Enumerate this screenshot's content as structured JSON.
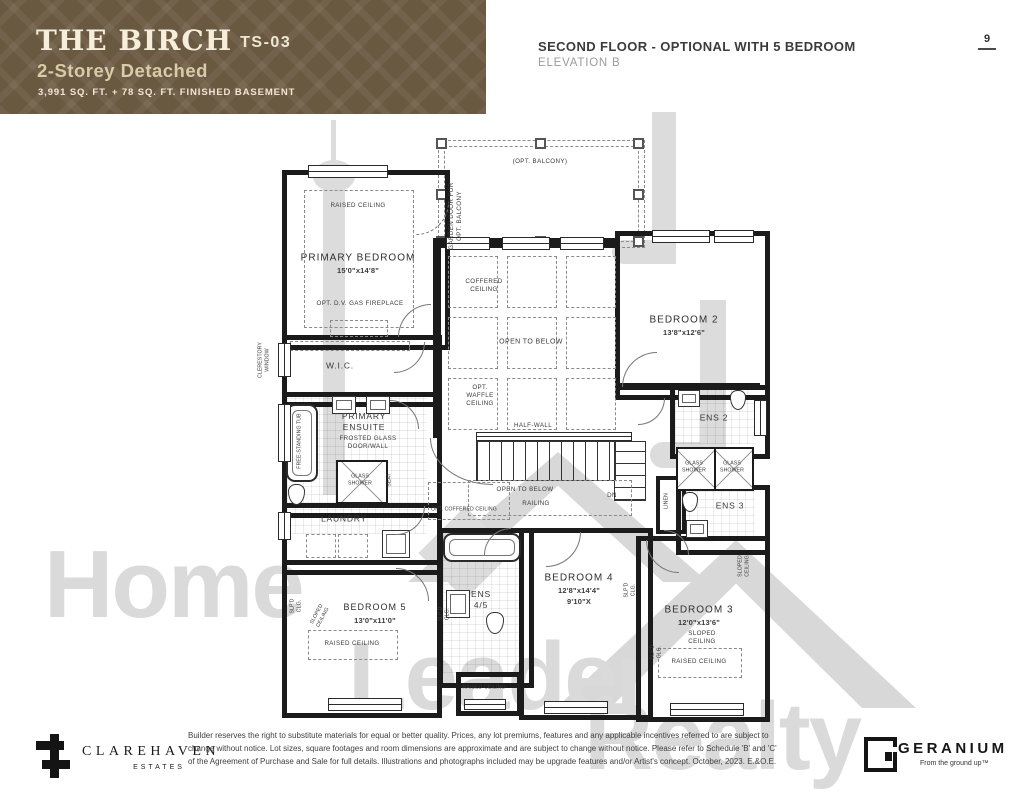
{
  "banner": {
    "title": "THE BIRCH",
    "model_code": "TS-03",
    "subtitle": "2-Storey Detached",
    "area_line": "3,991 SQ. FT. + 78 SQ. FT. FINISHED BASEMENT"
  },
  "header": {
    "title": "SECOND FLOOR - OPTIONAL WITH 5 BEDROOM",
    "subtitle": "ELEVATION B",
    "page_number": "9"
  },
  "watermark": {
    "word1": "Home",
    "word2": "Leader",
    "word3": "Realty"
  },
  "plan": {
    "balcony": "(OPT. BALCONY)",
    "garden_door_1": "GARDEN DOOR FOR",
    "garden_door_2": "OPT. BALCONY",
    "clerestory_1": "CLERESTORY",
    "clerestory_2": "WINDOW",
    "raised_ceiling": "RAISED CEILING",
    "primary_name": "PRIMARY BEDROOM",
    "primary_dims": "15'0\"x14'8\"",
    "fireplace": "OPT. D.V. GAS FIREPLACE",
    "wic": "W.I.C.",
    "ensuite_1": "PRIMARY",
    "ensuite_2": "ENSUITE",
    "frosted_1": "FROSTED GLASS",
    "frosted_2": "DOOR/WALL",
    "tub": "FREE-STANDING TUB",
    "glass_1": "GLASS",
    "glass_2": "SHOWER",
    "seat": "SEAT",
    "laundry": "LAUNDRY",
    "coffered_1": "COFFERED",
    "coffered_2": "CEILING",
    "open_to_below": "OPEN TO BELOW",
    "waffle_1": "OPT.",
    "waffle_2": "WAFFLE",
    "waffle_3": "CEILING",
    "half_wall": "HALF-WALL",
    "railing": "RAILING",
    "dn": "DN",
    "opt_coffered": "OPT. COFFERED CEILING",
    "bed2_name": "BEDROOM 2",
    "bed2_dims": "13'8\"x12'6\"",
    "ens2": "ENS 2",
    "ens3": "ENS 3",
    "linen": "LINEN",
    "bed4_name": "BEDROOM 4",
    "bed4_dims": "12'8\"x14'4\"",
    "bed4_dims2": "9'10\"X",
    "ens45_1": "ENS",
    "ens45_2": "4/5",
    "bed3_name": "BEDROOM 3",
    "bed3_dims": "12'0\"x13'6\"",
    "bed5_name": "BEDROOM 5",
    "bed5_dims": "13'0\"x11'0\"",
    "sloped_1": "SLOPED",
    "sloped_2": "CEILING",
    "slpd_1": "SLP'D",
    "slpd_2": "CLG."
  },
  "footer": {
    "disclaimer_1": "Builder reserves the right to substitute materials for equal or better quality. Prices, any lot premiums, features and any applicable incentives referred to are subject to",
    "disclaimer_2": "change without notice. Lot sizes, square footages and room dimensions are approximate and are subject to change without notice. Please refer to Schedule 'B' and 'C'",
    "disclaimer_3": "of the Agreement of Purchase and Sale for full details. Illustrations and photographs included may be upgrade features and/or Artist's concept. October, 2023. E.&O.E.",
    "clarehaven_name": "CLAREHAVEN",
    "clarehaven_sub": "ESTATES",
    "geranium_name": "GERANIUM",
    "geranium_tagline": "From the ground up™"
  }
}
